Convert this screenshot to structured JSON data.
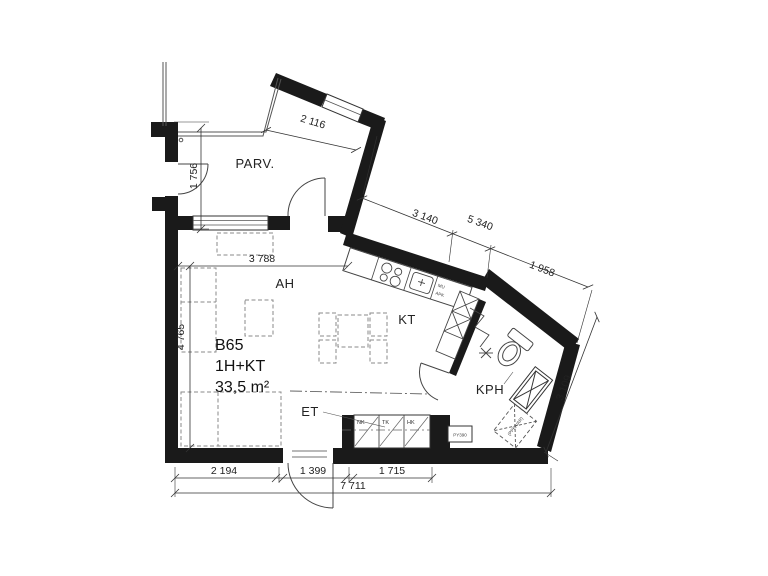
{
  "apartment": {
    "id": "B65",
    "layout": "1H+KT",
    "area": "33,5 m²"
  },
  "rooms": {
    "balcony": "PARV.",
    "living": "AH",
    "kitchen": "KT",
    "entry": "ET",
    "bathroom": "KPH"
  },
  "dims": {
    "parv_height": "1 756",
    "balcony_edge": "2 116",
    "upper_a": "3 140",
    "upper_b": "5 340",
    "upper_c": "1 958",
    "living_width": "3 788",
    "living_height": "4 765",
    "bath_side": "3 109",
    "bottom_a": "2 194",
    "bottom_b": "1 399",
    "bottom_c": "1 715",
    "bottom_total": "7 711"
  },
  "labels": {
    "closet_a": "NK",
    "closet_b": "TK",
    "closet_c": "HK",
    "duct": "PY390",
    "washer": "(PPK/VAR)",
    "micro": "MU",
    "dishwasher": "APK"
  },
  "colors": {
    "wall": "#1a1a1a",
    "line": "#444444",
    "furniture": "#8a8a8a",
    "dim": "#222222"
  }
}
